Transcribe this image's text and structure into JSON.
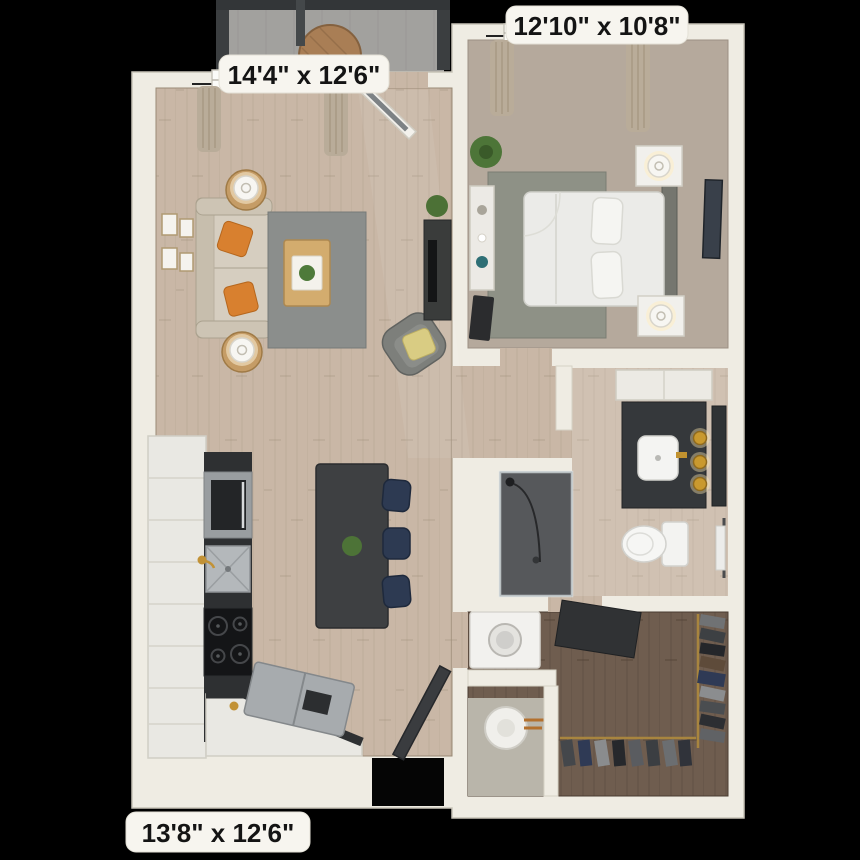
{
  "floorplan": {
    "view": "3d-top-down-apartment-floor-plan",
    "labels": {
      "living_room": "14'4\" x 12'6\"",
      "bedroom": "12'10\" x 10'8\"",
      "kitchen": "13'8\" x 12'6\""
    },
    "colors": {
      "background": "#000000",
      "wall": "#efece3",
      "wood_floor": "#c9b7a6",
      "bedroom_carpet": "#b5a99c",
      "closet_floor": "#6f5d4f",
      "balcony_floor": "#a2a19e",
      "rug_gray": "#8b8e8c",
      "accent_pillow_orange": "#d8802f",
      "accent_pillow_yellow": "#d9cc83",
      "island_charcoal": "#3e4042",
      "stool_navy": "#2d3a52",
      "counter_dark": "#2e3032",
      "stainless": "#a7abae",
      "brass_gold": "#c9992e",
      "label_background": "#f7f5ef",
      "label_text": "#141414"
    },
    "rooms": [
      {
        "name": "living-room",
        "dimensions": "14'4\" x 12'6\"",
        "furniture": [
          "sofa",
          "orange-throw-pillows",
          "round-side-tables-with-lamps",
          "gray-area-rug",
          "wood-coffee-table-with-plant",
          "swivel-armchair-with-yellow-pillow",
          "tv-console-with-plant",
          "gallery-wall-frames",
          "double-window-with-curtains",
          "balcony-door"
        ]
      },
      {
        "name": "bedroom",
        "dimensions": "12'10\" x 10'8\"",
        "furniture": [
          "bed-with-white-duvet",
          "gray-headboard",
          "two-nightstands-with-lamps",
          "dresser-with-decor",
          "area-rug",
          "corner-plant",
          "wall-art",
          "window-with-curtains"
        ]
      },
      {
        "name": "kitchen",
        "dimensions": "13'8\" x 12'6\"",
        "furniture": [
          "l-shaped-white-cabinets",
          "dark-countertop",
          "built-in-wall-oven",
          "stainless-sink-with-faucet",
          "four-burner-cooktop",
          "stainless-refrigerator",
          "island-with-plant",
          "three-navy-counter-stools"
        ]
      },
      {
        "name": "bathroom",
        "furniture": [
          "dark-vanity-with-vessel-sink",
          "three-brass-pendant-lights",
          "dark-framed-mirror",
          "linen-cabinet",
          "toilet",
          "walk-in-shower",
          "towel-bar"
        ]
      },
      {
        "name": "walk-in-closet",
        "furniture": [
          "hanging-clothes-two-racks",
          "corner-shelf",
          "front-load-washer",
          "water-heater"
        ]
      },
      {
        "name": "balcony",
        "furniture": [
          "round-wood-table",
          "metal-railing"
        ]
      },
      {
        "name": "entry",
        "furniture": [
          "open-front-door"
        ]
      }
    ]
  }
}
